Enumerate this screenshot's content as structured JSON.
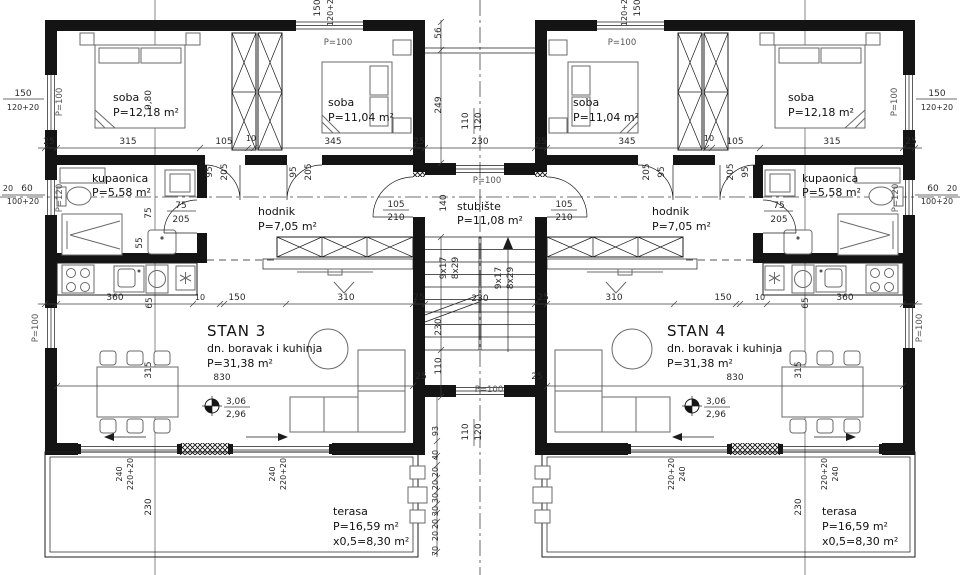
{
  "plan": {
    "stan3": {
      "title": "STAN 3",
      "desc": "dn. boravak i kuhinja",
      "area": "P=31,38 m²"
    },
    "stan4": {
      "title": "STAN 4",
      "desc": "dn. boravak i kuhinja",
      "area": "P=31,38 m²"
    },
    "soba_large": {
      "name": "soba",
      "area": "P=12,18 m²"
    },
    "soba_small": {
      "name": "soba",
      "area": "P=11,04 m²"
    },
    "kupaonica": {
      "name": "kupaonica",
      "area": "P=5,58 m²"
    },
    "hodnik": {
      "name": "hodnik",
      "area": "P=7,05 m²"
    },
    "stubiste": {
      "name": "stubište",
      "area": "P=11,08 m²"
    },
    "terasa": {
      "name": "terasa",
      "area": "P=16,59 m²",
      "half": "x0,5=8,30 m²"
    },
    "levels": {
      "upper": "3,06",
      "lower": "2,96"
    },
    "stair_run": {
      "steps": "9x17",
      "rise": "8x29"
    }
  },
  "openings": {
    "p100": "P=100",
    "p120": "P=120",
    "win_bed": {
      "w": "150",
      "h": "120+20"
    },
    "win_bath": {
      "w": "60",
      "h": "100+20"
    },
    "door_slide": {
      "w": "240",
      "h": "220+20"
    },
    "door_room": {
      "w": "95",
      "h": "205"
    },
    "door_bath": {
      "w": "75",
      "h": "205"
    },
    "door_entry": {
      "w": "105",
      "h": "210"
    }
  },
  "dims": {
    "rowTopLeft": [
      "25",
      "315",
      "105",
      "10",
      "345",
      "25"
    ],
    "rowTopRight": [
      "25",
      "345",
      "10",
      "105",
      "315",
      "25"
    ],
    "rowMidLeft": [
      "360",
      "65",
      "10",
      "150",
      "310",
      "25"
    ],
    "rowMidRight": [
      "25",
      "310",
      "150",
      "10",
      "65",
      "360"
    ],
    "stair": {
      "w56": "56",
      "w249": "249",
      "w110": "110",
      "w120": "120",
      "w230": "230",
      "w140": "140",
      "v230": "230",
      "v110": "110"
    },
    "porch": [
      "93",
      "40",
      "20",
      "20",
      "30",
      "30",
      "20",
      "20",
      "70"
    ],
    "porch_win": {
      "a": "110",
      "b": "120"
    },
    "v830": "830",
    "v315": "315",
    "v230": "230",
    "v980": "9,80",
    "bath": {
      "a": "75",
      "b": "55"
    },
    "edge20": "20"
  }
}
